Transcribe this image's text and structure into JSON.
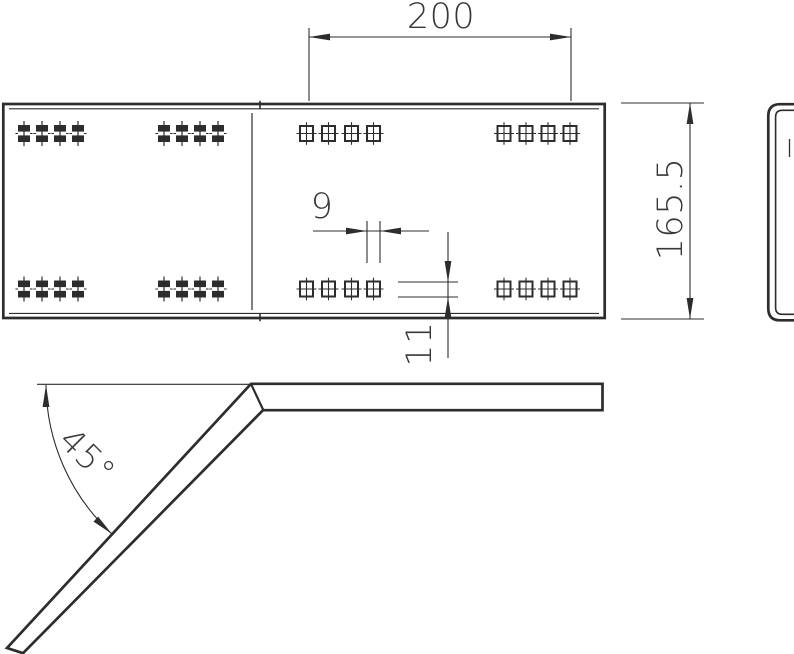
{
  "page": {
    "background": "#ffffff"
  },
  "drawing": {
    "line_color": "#2d2d2d",
    "text_color": "#383838",
    "dimensions": {
      "hole_pattern_span": {
        "value": "200"
      },
      "overall_height": {
        "value": "165.5"
      },
      "hole_width": {
        "value": "9"
      },
      "hole_height": {
        "value": "11"
      },
      "bend_angle": {
        "value": "45°"
      }
    },
    "views": {
      "plan_view": {
        "hole_groups": 8,
        "holes_per_group": 4,
        "hole_styles": [
          "filled-slot",
          "open-slot-crosshair"
        ]
      },
      "side_profile": {
        "shape": "c-channel"
      },
      "bend_profile": {
        "shape": "45-degree-bend"
      }
    }
  }
}
